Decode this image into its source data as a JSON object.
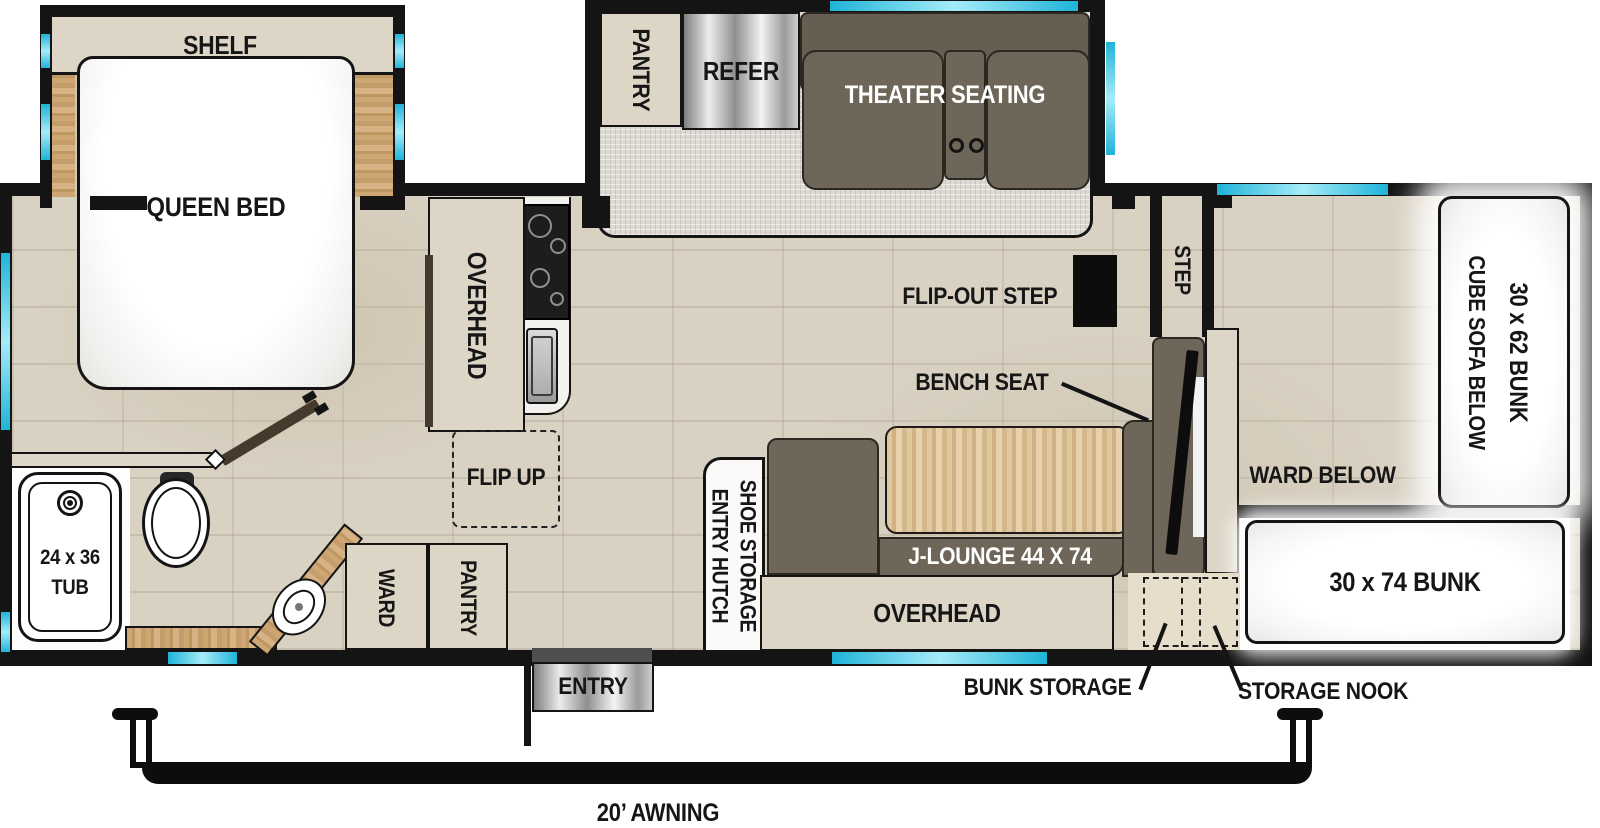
{
  "title": "Travel trailer floor plan",
  "colors": {
    "wall": "#141414",
    "window_accent": "#1fb3d8",
    "cabinet_tan": "#ddd6c7",
    "sofa_olive": "#6e6658",
    "deck_wood": "#c9a06c",
    "table_wood": "#dcc49b",
    "tile_floor": "#d9d1c2",
    "slide_carpet": "#dddad3",
    "label_text": "#161616"
  },
  "bedroom": {
    "shelf": "SHELF",
    "queen_bed": "QUEEN BED"
  },
  "galley_slide": {
    "pantry": "PANTRY",
    "refer": "REFER",
    "theater_seating": "THEATER SEATING"
  },
  "kitchen": {
    "overhead": "OVERHEAD",
    "flip_up": "FLIP UP"
  },
  "bath": {
    "tub_size": "24 x 36",
    "tub": "TUB",
    "ward": "WARD",
    "pantry": "PANTRY"
  },
  "lounge": {
    "entry_hutch": "ENTRY HUTCH",
    "shoe_storage": "SHOE STORAGE",
    "j_lounge": "J-LOUNGE 44 X 74",
    "overhead": "OVERHEAD",
    "bench_seat": "BENCH SEAT",
    "flip_out_step": "FLIP-OUT STEP",
    "step": "STEP"
  },
  "bunk_room": {
    "bunk_30x62": "30 x 62 BUNK",
    "cube_sofa_below": "CUBE SOFA BELOW",
    "ward_below": "WARD BELOW",
    "bunk_30x74": "30 x 74 BUNK",
    "bunk_storage": "BUNK STORAGE",
    "storage_nook": "STORAGE NOOK"
  },
  "exterior": {
    "entry": "ENTRY",
    "awning": "20’ AWNING"
  }
}
